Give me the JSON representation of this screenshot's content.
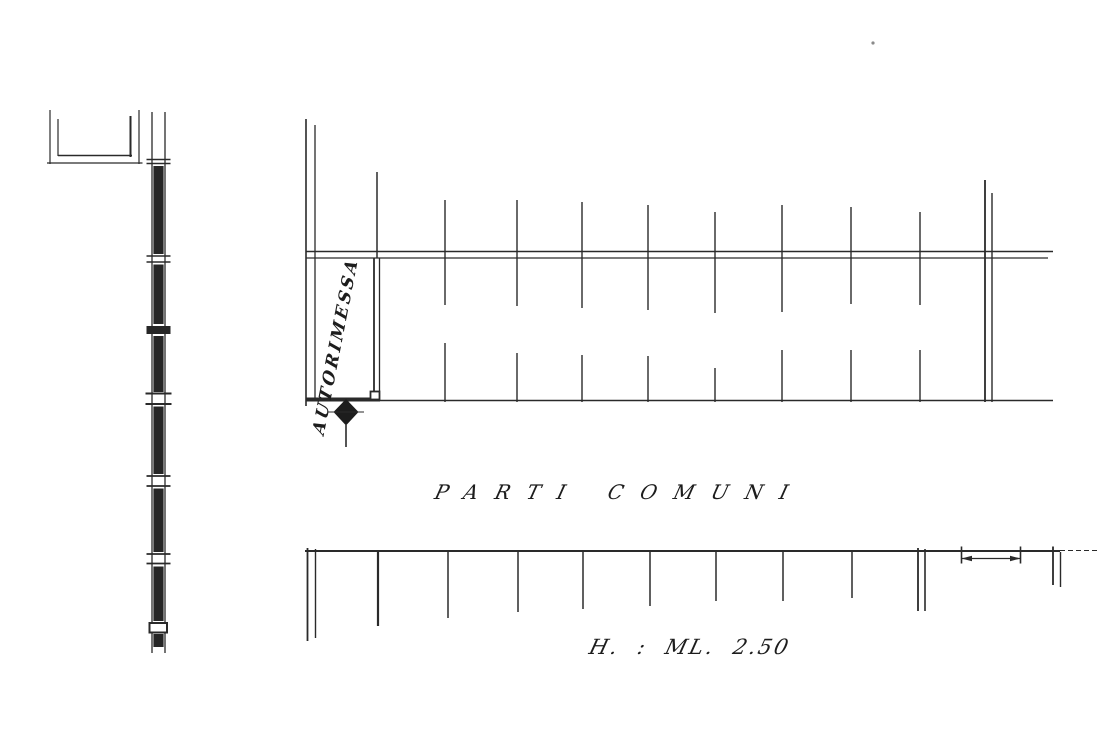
{
  "page": {
    "paper_color": "#ffffff",
    "ink_color": "#2a2a2a"
  },
  "plan": {
    "garage_label": "AUTORIMESSA",
    "common_area_word1": "PARTI",
    "common_area_word2": "COMUNI",
    "height_note": "H. : ML. 2.50"
  }
}
